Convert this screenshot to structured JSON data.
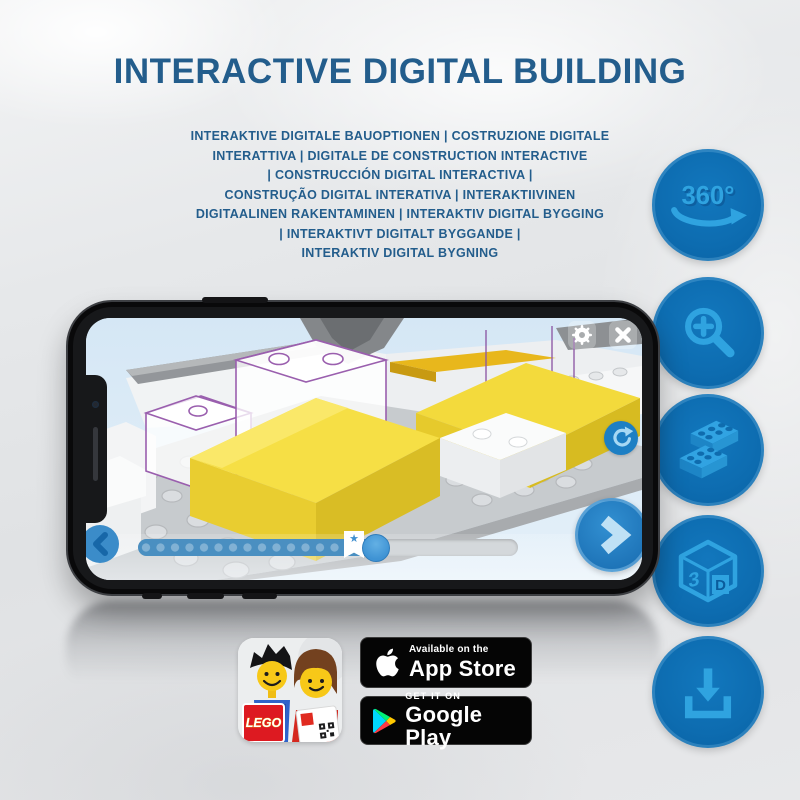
{
  "header": {
    "title": "INTERACTIVE DIGITAL BUILDING",
    "subtitle": "INTERAKTIVE DIGITALE BAUOPTIONEN | COSTRUZIONE DIGITALE\nINTERATTIVA | DIGITALE DE CONSTRUCTION INTERACTIVE\n| CONSTRUCCIÓN DIGITAL INTERACTIVA |\nCONSTRUÇÃO DIGITAL INTERATIVA | INTERAKTIIVINEN\nDIGITAALINEN RAKENTAMINEN | INTERAKTIV DIGITAL BYGGING\n| INTERAKTIVT DIGITALT BYGGANDE |\nINTERAKTIV DIGITAL BYGNING"
  },
  "features": {
    "items": [
      {
        "name": "360-rotation",
        "label": "360°"
      },
      {
        "name": "zoom-in",
        "label": ""
      },
      {
        "name": "brick-stack",
        "label": ""
      },
      {
        "name": "3d-view",
        "label": "3D",
        "cube_left": "3",
        "cube_right": "D"
      },
      {
        "name": "download",
        "label": ""
      }
    ]
  },
  "phone": {
    "screen": {
      "slider": {
        "progress_percent": 62,
        "step_dots": 17
      },
      "controls": [
        "settings",
        "close",
        "rotate",
        "back",
        "next"
      ]
    }
  },
  "icons": {
    "star": "★"
  },
  "store_badges": {
    "lego_app": {
      "logo_text": "LEGO"
    },
    "app_store": {
      "line1": "Available on the",
      "line2": "App Store"
    },
    "google_play": {
      "line1": "GET IT ON",
      "line2": "Google Play"
    }
  },
  "colors": {
    "title_blue": "#235d8c",
    "circle_blue": "#0d6cb0",
    "glyph_blue": "#2fa3e0",
    "screen_sky": "#d9e9f6",
    "ui_blue": "#2b84c6",
    "lego_red": "#dd1a21",
    "brick_yellow": "#f2d83c"
  }
}
